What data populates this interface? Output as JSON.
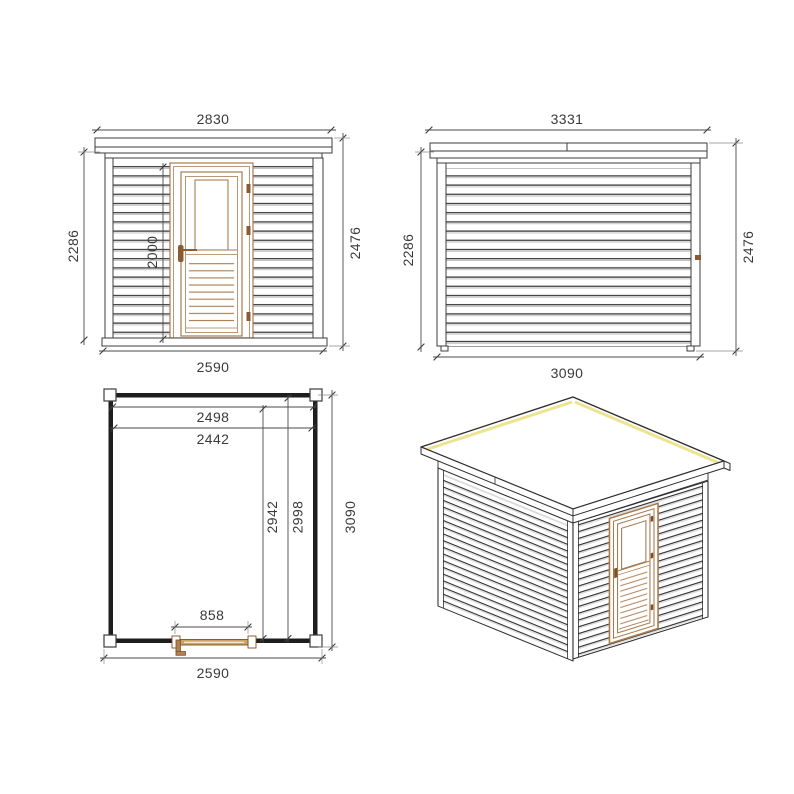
{
  "drawing": {
    "front_elevation": {
      "roof_width": "2830",
      "wall_height": "2286",
      "door_height": "2000",
      "total_height": "2476",
      "base_width": "2590"
    },
    "side_elevation": {
      "roof_width": "3331",
      "wall_height": "2286",
      "total_height": "2476",
      "base_width": "3090"
    },
    "floor_plan": {
      "inner_width_a": "2498",
      "inner_width_b": "2442",
      "inner_depth_a": "2942",
      "inner_depth_b": "2998",
      "outer_depth": "3090",
      "door_width": "858",
      "outer_width": "2590"
    },
    "colors": {
      "line": "#3d3d3d",
      "slat_shadow": "#b8b8b8",
      "wood_frame": "#a97c50",
      "wood_dark": "#7d4f22",
      "wood_fill": "#c9a469",
      "roof_highlight": "#ece48f"
    }
  }
}
